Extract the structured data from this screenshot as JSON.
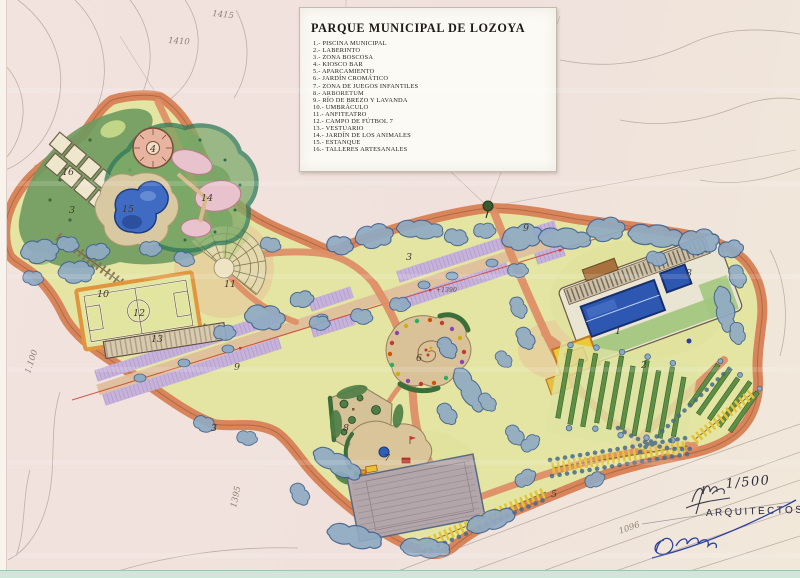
{
  "legend": {
    "title": "PARQUE MUNICIPAL DE LOZOYA",
    "items": [
      "1.- PISCINA MUNICIPAL",
      "2.- LABERINTO",
      "3.- ZONA BOSCOSA",
      "4.- KIOSCO BAR",
      "5.- APARCAMIENTO",
      "6.- JARDÍN CROMÁTICO",
      "7.- ZONA DE JUEGOS INFANTILES",
      "8.- ARBORETUM",
      "9.- RÍO DE BREZO Y LAVANDA",
      "10.- UMBRÁCULO",
      "11.- ANFITEATRO",
      "12.- CAMPO DE FÚTBOL 7",
      "13.- VESTUARIO",
      "14.- JARDÍN DE LOS ANIMALES",
      "15.- ESTANQUE",
      "16.- TALLERES ARTESANALES"
    ]
  },
  "map_labels": {
    "piscina": "1",
    "laberinto": "2",
    "boscosa_a": "3",
    "boscosa_b": "3",
    "boscosa_c": "3",
    "boscosa_d": "3",
    "kiosco": "4",
    "aparcamiento": "5",
    "cromatico": "6",
    "juegos": "7",
    "arboretum": "8",
    "rio_a": "9",
    "rio_b": "9",
    "umbraculo": "10",
    "anfiteatro": "11",
    "futbol": "12",
    "vestuario": "13",
    "animales": "14",
    "estanque": "15",
    "talleres": "16"
  },
  "annotations": {
    "scale": "1/500",
    "credit": "ARQUITECTOS",
    "spot_elevation": "+1390",
    "contour_a": "1415",
    "contour_b": "1410",
    "contour_c": "1.100",
    "contour_d": "1395",
    "contour_e": "1096"
  },
  "colors": {
    "paper": "#f1e2dd",
    "park_ground": "#e4e5a2",
    "path_salmon": "#de8f68",
    "tree_blue": "#8fabc4",
    "forest_green": "#6e9a60",
    "lavender": "#c7b3da",
    "water_blue": "#2e57b2",
    "building_yellow": "#ecc937",
    "ink_blue": "#2b3f9e"
  }
}
